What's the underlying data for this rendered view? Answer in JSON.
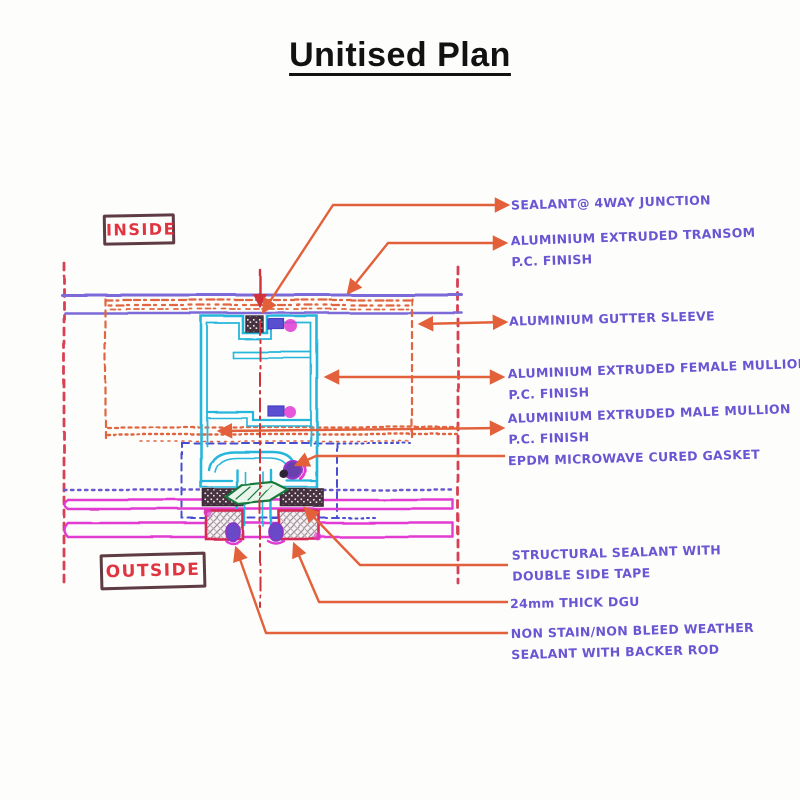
{
  "title": "Unitised Plan",
  "side_labels": {
    "inside": "INSIDE",
    "outside": "OUTSIDE"
  },
  "annotations": [
    {
      "id": "sealant-4way",
      "lines": [
        "SEALANT@ 4WAY JUNCTION"
      ]
    },
    {
      "id": "transom",
      "lines": [
        "ALUMINIUM EXTRUDED TRANSOM",
        "P.C. FINISH"
      ]
    },
    {
      "id": "gutter-sleeve",
      "lines": [
        "ALUMINIUM GUTTER SLEEVE"
      ]
    },
    {
      "id": "female-mullion",
      "lines": [
        "ALUMINIUM EXTRUDED FEMALE MULLION",
        "P.C. FINISH"
      ]
    },
    {
      "id": "male-mullion",
      "lines": [
        "ALUMINIUM EXTRUDED MALE MULLION",
        "P.C. FINISH"
      ]
    },
    {
      "id": "epdm-gasket",
      "lines": [
        "EPDM MICROWAVE CURED GASKET"
      ]
    },
    {
      "id": "structural-sealant",
      "lines": [
        "STRUCTURAL SEALANT WITH",
        "DOUBLE SIDE TAPE"
      ]
    },
    {
      "id": "dgu",
      "lines": [
        "24mm THICK DGU"
      ]
    },
    {
      "id": "weather-sealant",
      "lines": [
        "NON STAIN/NON BLEED WEATHER",
        "SEALANT WITH BACKER ROD"
      ]
    }
  ],
  "colors": {
    "annotation_text": "#6a55d2",
    "leader_arrow": "#e2603a",
    "inside_outside_text": "#e03440",
    "inside_outside_border": "#5f3c44",
    "boundary_dashed_red": "#d84052",
    "mullion_profile_cyan": "#25b6dc",
    "transom_lines_purple": "#7b6ad8",
    "transom_hatch_orange": "#e0653f",
    "glass_lines_magenta": "#e23ad2",
    "male_zone_dashed_blue": "#4a4ed0",
    "gasket_green": "#177a3e",
    "setting_block_crimson": "#d62a55",
    "sealant_block_dark": "#46313f",
    "centerline_red": "#d0303a",
    "title_text": "#121212"
  }
}
